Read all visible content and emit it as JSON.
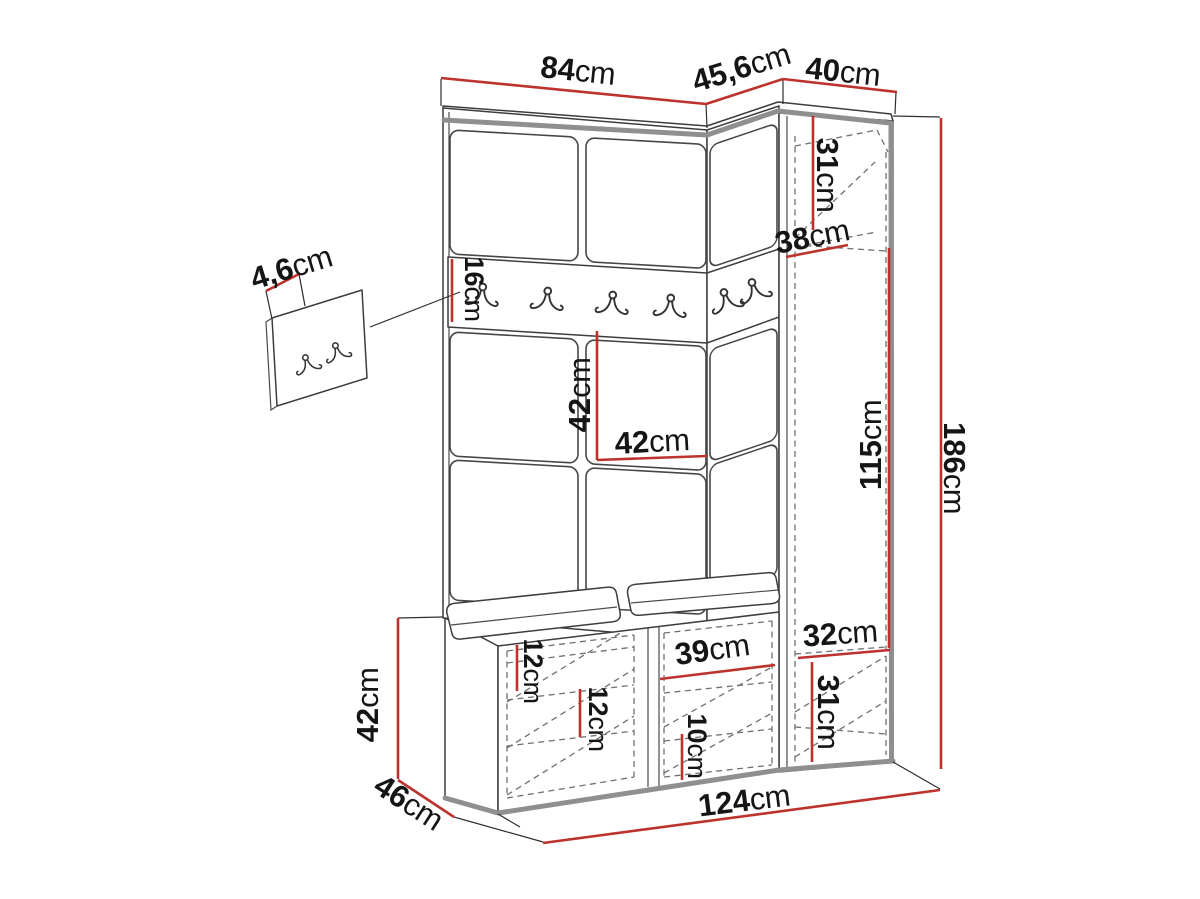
{
  "diagram": {
    "description": "Hallway furniture set dimension diagram (panel wall with coat rail, corner wardrobe, shoe bench, wall hook panel)",
    "unit": "cm",
    "accent_color": "#bd322c",
    "outline_color": "#3d3d3d",
    "shadow_edge_color": "#8f8f8f",
    "counts": {
      "rail_hooks": 6,
      "wall_panel_hooks": 2
    },
    "dimensions": {
      "main_top_width": {
        "value": "84",
        "unit": "cm"
      },
      "corner_top_width": {
        "value": "45,6",
        "unit": "cm"
      },
      "wardrobe_top_width": {
        "value": "40",
        "unit": "cm"
      },
      "wall_panel_thickness": {
        "value": "4,6",
        "unit": "cm"
      },
      "rail_height": {
        "value": "16",
        "unit": "cm"
      },
      "panel_height": {
        "value": "42",
        "unit": "cm"
      },
      "panel_width": {
        "value": "42",
        "unit": "cm"
      },
      "wardrobe_top_shelf_height": {
        "value": "31",
        "unit": "cm"
      },
      "wardrobe_shelf_depth": {
        "value": "38",
        "unit": "cm"
      },
      "wardrobe_hanging_height": {
        "value": "115",
        "unit": "cm"
      },
      "total_height": {
        "value": "186",
        "unit": "cm"
      },
      "wardrobe_lower_shelf_width": {
        "value": "32",
        "unit": "cm"
      },
      "wardrobe_lower_shelf_height": {
        "value": "31",
        "unit": "cm"
      },
      "bench_top_offset": {
        "value": "12",
        "unit": "cm"
      },
      "bench_shelf_spacing": {
        "value": "12",
        "unit": "cm"
      },
      "bench_compartment_width": {
        "value": "39",
        "unit": "cm"
      },
      "bench_lower_shelf_height": {
        "value": "10",
        "unit": "cm"
      },
      "bench_height": {
        "value": "42",
        "unit": "cm"
      },
      "bench_depth": {
        "value": "46",
        "unit": "cm"
      },
      "total_width": {
        "value": "124",
        "unit": "cm"
      }
    }
  }
}
